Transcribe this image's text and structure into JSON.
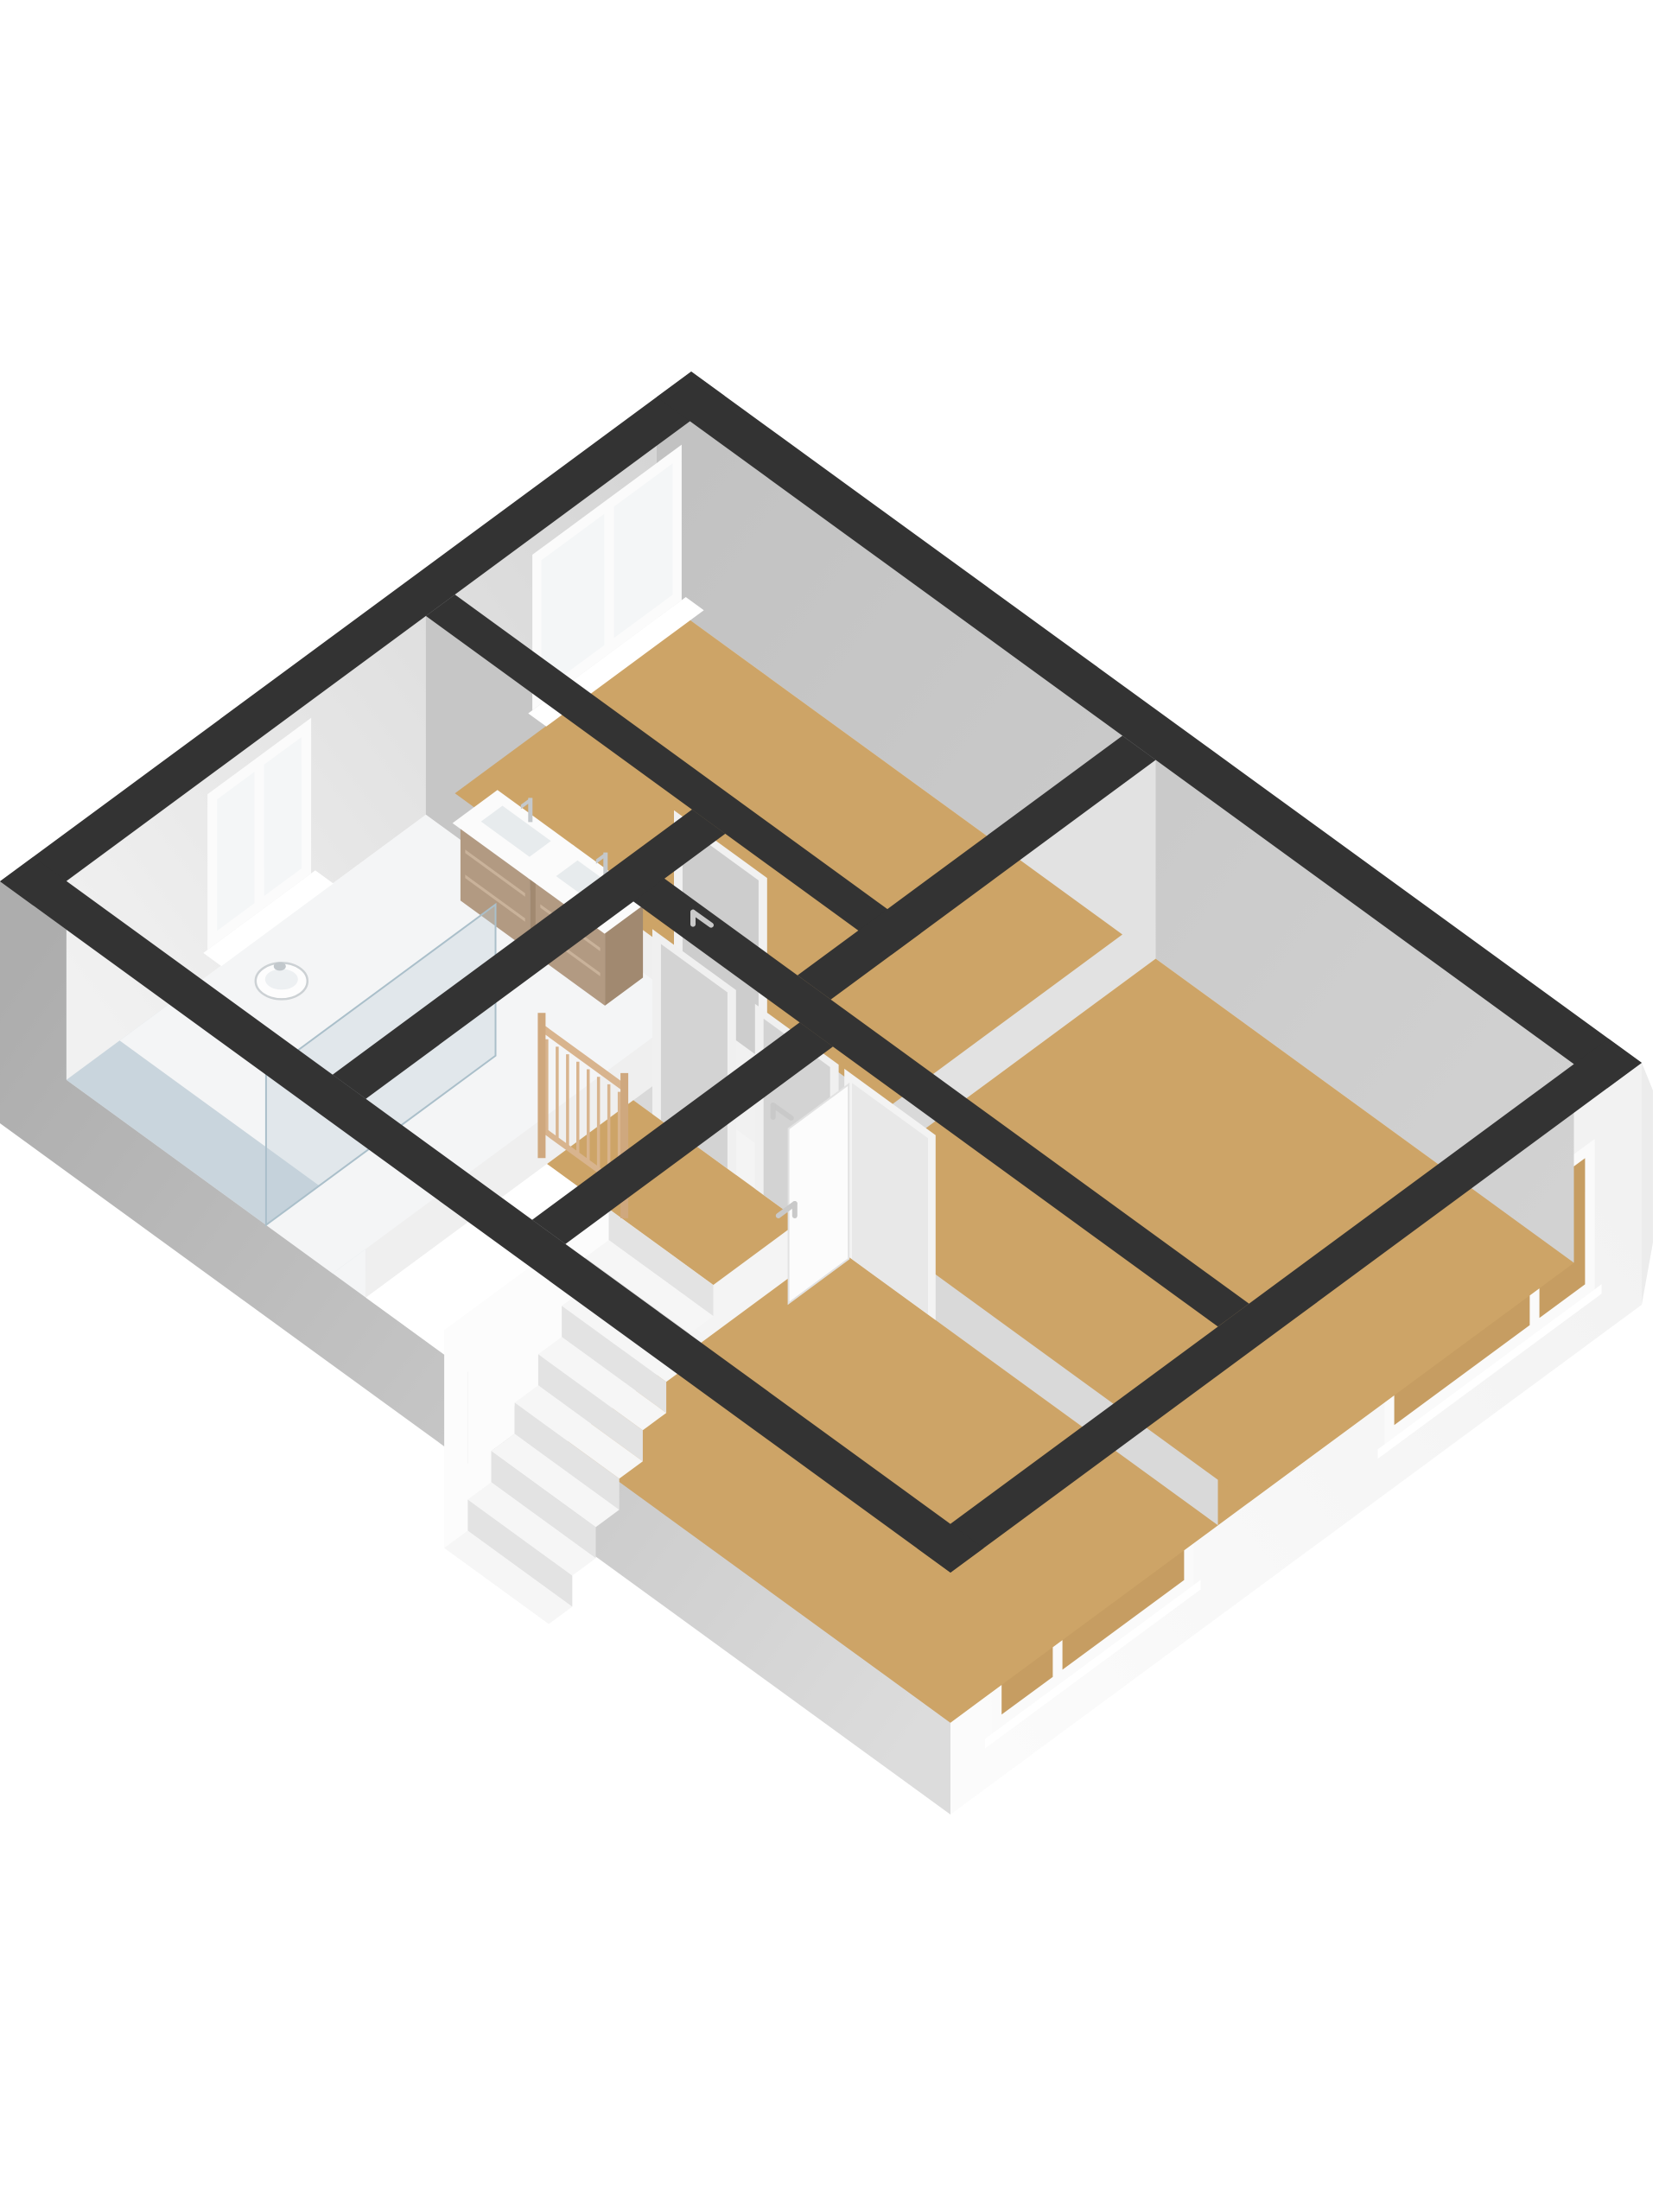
{
  "meta": {
    "description": "3D floor plan render of an upper floor with three bedrooms, bathroom, landing and staircase",
    "background": "#ffffff"
  },
  "palette": {
    "wall_top": "#333333",
    "wood_floor": "#cda467",
    "light_floor": "#f1f1f1",
    "bath_floor": "#f4f5f6",
    "shower_floor": "#c9d5dd",
    "exterior_gray": "#b0b0b0",
    "exterior_white": "#f7f7f7",
    "railing_wood": "#d8b48e",
    "vanity_wood": "#b29a82"
  },
  "scene": {
    "projection": {
      "origin": [
        800,
        430
      ],
      "uAxis": [
        1100,
        800
      ],
      "vAxis": [
        -800,
        590
      ],
      "floorZ": 230,
      "wallZ": 280
    },
    "gradients": [
      {
        "id": "gw1",
        "a": [
          0.035,
          0.05,
          100
        ],
        "b": [
          0.035,
          0.952,
          100
        ],
        "stops": [
          [
            0,
            "#d5d5d5"
          ],
          [
            1,
            "#f1f1f1"
          ]
        ]
      },
      {
        "id": "gw2",
        "a": [
          0,
          0.05,
          100
        ],
        "b": [
          1,
          0.05,
          100
        ],
        "stops": [
          [
            0,
            "#c2c2c2"
          ],
          [
            1,
            "#d2d2d2"
          ]
        ]
      },
      {
        "id": "gw3",
        "a": [
          1,
          0,
          140
        ],
        "b": [
          1,
          1,
          140
        ],
        "stops": [
          [
            0,
            "#f2f2f2"
          ],
          [
            1,
            "#fbfbfb"
          ]
        ]
      },
      {
        "id": "gw4",
        "a": [
          0,
          1,
          140
        ],
        "b": [
          1,
          1,
          140
        ],
        "stops": [
          [
            0,
            "#adadad"
          ],
          [
            1,
            "#dcdcdc"
          ]
        ]
      }
    ],
    "items": [
      {
        "type": "uquad",
        "name": "exterior-face-bottom-right-wall",
        "u": 1,
        "v0": 0,
        "v1": 1,
        "z0": 0,
        "z1": 280,
        "fill": "url(#gw3)"
      },
      {
        "type": "vquad",
        "name": "exterior-face-bottom-left-wall",
        "v": 1,
        "u0": 0,
        "u1": 1,
        "z0": 0,
        "z1": 280,
        "fill": "url(#gw4)"
      },
      {
        "type": "poly",
        "name": "right-corner-edge-sliver",
        "points": [
          [
            1900,
            1230
          ],
          [
            1913,
            1262
          ],
          [
            1913,
            1438
          ],
          [
            1900,
            1510
          ]
        ],
        "fill": "#ececec"
      },
      {
        "type": "uquad",
        "name": "window-right-bedroom-frame",
        "u": 1,
        "v0": 0.068,
        "v1": 0.372,
        "z0": 48,
        "z1": 222,
        "fill": "#fafafa"
      },
      {
        "type": "uquad",
        "name": "window-right-bedroom-pane-small",
        "u": 1,
        "v0": 0.082,
        "v1": 0.148,
        "z0": 62,
        "z1": 208,
        "fill": "#c69d62"
      },
      {
        "type": "uquad",
        "name": "window-right-bedroom-pane-large",
        "u": 1,
        "v0": 0.162,
        "v1": 0.358,
        "z0": 62,
        "z1": 208,
        "fill": "#c69d62"
      },
      {
        "type": "uquad",
        "name": "window-right-bedroom-sill",
        "u": 1,
        "v0": 0.058,
        "v1": 0.382,
        "z0": 222,
        "z1": 233,
        "fill": "#ffffff"
      },
      {
        "type": "uquad",
        "name": "window-bottom-bedroom-frame",
        "u": 1,
        "v0": 0.648,
        "v1": 0.94,
        "z0": 48,
        "z1": 222,
        "fill": "#fafafa"
      },
      {
        "type": "uquad",
        "name": "window-bottom-bedroom-pane-large",
        "u": 1,
        "v0": 0.662,
        "v1": 0.838,
        "z0": 62,
        "z1": 208,
        "fill": "#c69d62"
      },
      {
        "type": "uquad",
        "name": "window-bottom-bedroom-pane-small",
        "u": 1,
        "v0": 0.852,
        "v1": 0.926,
        "z0": 62,
        "z1": 208,
        "fill": "#c69d62"
      },
      {
        "type": "uquad",
        "name": "window-bottom-bedroom-sill",
        "u": 1,
        "v0": 0.638,
        "v1": 0.95,
        "z0": 222,
        "z1": 233,
        "fill": "#ffffff"
      },
      {
        "type": "uquad",
        "name": "floor-skirt-right-wall",
        "u": 0.965,
        "v0": 0.05,
        "v1": 0.952,
        "z0": 0,
        "z1": 230,
        "fill": "#cda467"
      },
      {
        "type": "vquad",
        "name": "floor-skirt-bottom-wall-shower",
        "v": 0.952,
        "u0": 0.035,
        "u1": 0.245,
        "z0": 0,
        "z1": 230,
        "fill": "#c9d5dd"
      },
      {
        "type": "vquad",
        "name": "floor-skirt-bottom-wall-bath",
        "v": 0.952,
        "u0": 0.245,
        "u1": 0.35,
        "z0": 0,
        "z1": 230,
        "fill": "#f4f5f6"
      },
      {
        "type": "vquad",
        "name": "floor-skirt-bottom-wall-stairwell",
        "v": 0.952,
        "u0": 0.35,
        "u1": 0.56,
        "z0": 0,
        "z1": 230,
        "fill": "#fdfdfd"
      },
      {
        "type": "vquad",
        "name": "floor-skirt-bottom-wall-bedroom",
        "v": 0.952,
        "u0": 0.56,
        "u1": 0.965,
        "z0": 0,
        "z1": 230,
        "fill": "#cda467"
      },
      {
        "type": "vquad",
        "name": "floor-skirt-top-bedroom-south",
        "v": 0.39,
        "u0": 0.035,
        "u1": 0.525,
        "z0": 0,
        "z1": 230,
        "fill": "#cda467"
      },
      {
        "type": "uquad",
        "name": "floor-skirt-top-bedroom-east",
        "u": 0.49,
        "v0": 0.05,
        "v1": 0.39,
        "z0": 0,
        "z1": 230,
        "fill": "#cda467"
      },
      {
        "type": "uquad",
        "name": "floor-skirt-hall-east",
        "u": 0.49,
        "v0": 0.39,
        "v1": 0.52,
        "z0": 0,
        "z1": 230,
        "fill": "#f1f1f1"
      },
      {
        "type": "vquad",
        "name": "floor-skirt-hall-south",
        "v": 0.52,
        "u0": 0.345,
        "u1": 0.525,
        "z0": 0,
        "z1": 230,
        "fill": "#f1f1f1"
      },
      {
        "type": "vquad",
        "name": "floor-skirt-right-bedroom-south",
        "v": 0.52,
        "u0": 0.525,
        "u1": 0.965,
        "z0": 0,
        "z1": 230,
        "fill": "#cda467"
      },
      {
        "type": "uquad",
        "name": "floor-skirt-bathroom-east",
        "u": 0.315,
        "v0": 0.432,
        "v1": 0.875,
        "z0": 0,
        "z1": 230,
        "fill": "#f4f5f6"
      },
      {
        "type": "uquad",
        "name": "floor-skirt-shower-east",
        "u": 0.315,
        "v0": 0.875,
        "v1": 0.952,
        "z0": 0,
        "z1": 230,
        "fill": "#c9d5dd"
      },
      {
        "type": "uquad",
        "name": "floor-skirt-landing-east",
        "u": 0.525,
        "v0": 0.565,
        "v1": 0.69,
        "z0": 0,
        "z1": 230,
        "fill": "#cda467"
      },
      {
        "type": "uquad",
        "name": "floor-skirt-stairs-east",
        "u": 0.525,
        "v0": 0.69,
        "v1": 0.952,
        "z0": 0,
        "z1": 230,
        "fill": "#fdfdfd"
      },
      {
        "type": "uquad",
        "name": "interior-face-top-left-wall",
        "u": 0.035,
        "v0": 0.05,
        "v1": 0.952,
        "z0": 0,
        "z1": 230,
        "fill": "url(#gw1)"
      },
      {
        "type": "vquad",
        "name": "interior-face-top-right-wall",
        "v": 0.05,
        "u0": 0,
        "u1": 0.965,
        "z0": 0,
        "z1": 230,
        "fill": "url(#gw2)"
      },
      {
        "type": "vquad",
        "name": "interior-face-partition-top-bedroom",
        "v": 0.432,
        "u0": 0.035,
        "u1": 0.525,
        "z0": 0,
        "z1": 230,
        "fill": "#c6c6c6"
      },
      {
        "type": "uquad",
        "name": "interior-face-partition-right-bedroom-west",
        "u": 0.525,
        "v0": 0.05,
        "v1": 0.52,
        "z0": 0,
        "z1": 230,
        "fill": "#e2e2e2"
      },
      {
        "type": "vquad",
        "name": "interior-face-partition-landing-north",
        "v": 0.565,
        "u0": 0.345,
        "u1": 0.965,
        "z0": 0,
        "z1": 230,
        "fill": "#d9d9d9"
      },
      {
        "type": "uquad",
        "name": "interior-face-partition-bathroom-east",
        "u": 0.35,
        "v0": 0.432,
        "v1": 0.952,
        "z0": 0,
        "z1": 230,
        "fill": "#efefef"
      },
      {
        "type": "uquad",
        "name": "interior-face-partition-bottom-bedroom-west",
        "u": 0.56,
        "v0": 0.565,
        "v1": 0.952,
        "z0": 0,
        "z1": 230,
        "fill": "#f4f4f4"
      },
      {
        "type": "plan",
        "name": "floor-top-bedroom",
        "u0": 0.035,
        "u1": 0.49,
        "v0": 0.05,
        "v1": 0.39,
        "z": 230,
        "fill": "#cda467"
      },
      {
        "type": "plan",
        "name": "floor-right-bedroom",
        "u0": 0.525,
        "u1": 0.965,
        "v0": 0.05,
        "v1": 0.52,
        "z": 230,
        "fill": "#cda467"
      },
      {
        "type": "plan",
        "name": "floor-bottom-bedroom",
        "u0": 0.56,
        "u1": 0.965,
        "v0": 0.565,
        "v1": 0.952,
        "z": 230,
        "fill": "#cda467"
      },
      {
        "type": "plan",
        "name": "floor-hallway",
        "u0": 0.35,
        "u1": 0.49,
        "v0": 0.432,
        "v1": 0.52,
        "z": 230,
        "fill": "#f1f1f1"
      },
      {
        "type": "plan",
        "name": "floor-landing",
        "u0": 0.35,
        "u1": 0.525,
        "v0": 0.565,
        "v1": 0.69,
        "z": 230,
        "fill": "#cda467"
      },
      {
        "type": "plan",
        "name": "floor-bathroom",
        "u0": 0.035,
        "u1": 0.315,
        "v0": 0.432,
        "v1": 0.952,
        "z": 230,
        "fill": "#f4f5f6"
      },
      {
        "type": "plan",
        "name": "floor-shower",
        "u0": 0.035,
        "u1": 0.245,
        "v0": 0.875,
        "v1": 0.952,
        "z": 230,
        "fill": "#c9d5dd"
      },
      {
        "type": "plan",
        "name": "floor-stair-void",
        "u0": 0.35,
        "u1": 0.525,
        "v0": 0.69,
        "v1": 0.952,
        "z": 230,
        "fill": "#ffffff"
      },
      {
        "type": "uquad",
        "name": "window-top-bedroom-frame",
        "u": 0.035,
        "v0": 0.062,
        "v1": 0.278,
        "z0": 20,
        "z1": 200,
        "fill": "#fbfbfb"
      },
      {
        "type": "uquad",
        "name": "window-top-bedroom-pane-left",
        "u": 0.035,
        "v0": 0.174,
        "v1": 0.265,
        "z0": 34,
        "z1": 186,
        "fill": "#f4f6f7"
      },
      {
        "type": "uquad",
        "name": "window-top-bedroom-pane-right",
        "u": 0.035,
        "v0": 0.075,
        "v1": 0.16,
        "z0": 34,
        "z1": 186,
        "fill": "#f4f6f7"
      },
      {
        "type": "plan",
        "name": "window-top-bedroom-sill",
        "u0": 0.035,
        "u1": 0.054,
        "v0": 0.056,
        "v1": 0.284,
        "z": 200,
        "fill": "#ffffff"
      },
      {
        "type": "uquad",
        "name": "window-bathroom-frame",
        "u": 0.035,
        "v0": 0.598,
        "v1": 0.748,
        "z0": 20,
        "z1": 200,
        "fill": "#fbfbfb"
      },
      {
        "type": "uquad",
        "name": "window-bathroom-pane-left",
        "u": 0.035,
        "v0": 0.68,
        "v1": 0.734,
        "z0": 34,
        "z1": 186,
        "fill": "#f4f6f7"
      },
      {
        "type": "uquad",
        "name": "window-bathroom-pane-right",
        "u": 0.035,
        "v0": 0.612,
        "v1": 0.666,
        "z0": 34,
        "z1": 186,
        "fill": "#f4f6f7"
      },
      {
        "type": "plan",
        "name": "window-bathroom-sill",
        "u0": 0.035,
        "u1": 0.054,
        "v0": 0.592,
        "v1": 0.754,
        "z": 200,
        "fill": "#ffffff"
      },
      {
        "type": "vquad",
        "name": "door-top-bedroom-frame",
        "v": 0.432,
        "u0": 0.296,
        "u1": 0.394,
        "z0": 16,
        "z1": 230,
        "fill": "#f1f1f1"
      },
      {
        "type": "vquad",
        "name": "door-top-bedroom-leaf",
        "v": 0.432,
        "u0": 0.305,
        "u1": 0.385,
        "z0": 26,
        "z1": 230,
        "fill": "#cdcdcd"
      },
      {
        "type": "vquad",
        "name": "door-landing-left-frame",
        "v": 0.565,
        "u0": 0.37,
        "u1": 0.458,
        "z0": 16,
        "z1": 230,
        "fill": "#f0f0f0"
      },
      {
        "type": "vquad",
        "name": "door-landing-left-leaf",
        "v": 0.565,
        "u0": 0.379,
        "u1": 0.449,
        "z0": 26,
        "z1": 230,
        "fill": "#d3d3d3"
      },
      {
        "type": "vquad",
        "name": "door-landing-right-frame",
        "v": 0.565,
        "u0": 0.478,
        "u1": 0.566,
        "z0": 16,
        "z1": 230,
        "fill": "#f0f0f0"
      },
      {
        "type": "vquad",
        "name": "door-landing-right-leaf",
        "v": 0.565,
        "u0": 0.487,
        "u1": 0.557,
        "z0": 26,
        "z1": 230,
        "fill": "#d3d3d3"
      },
      {
        "type": "vquad",
        "name": "door-bottom-bedroom-frame",
        "v": 0.565,
        "u0": 0.572,
        "u1": 0.668,
        "z0": 16,
        "z1": 230,
        "fill": "#f3f3f3"
      },
      {
        "type": "vquad",
        "name": "door-bottom-bedroom-opening",
        "v": 0.565,
        "u0": 0.58,
        "u1": 0.66,
        "z0": 26,
        "z1": 230,
        "fill": "#e8e8e8"
      },
      {
        "type": "stairs",
        "name": "staircase",
        "u0": 0.415,
        "u1": 0.525,
        "vStart": 0.69,
        "depth": 0.034,
        "count": 7,
        "drop": 36,
        "treadFill": "#f6f6f6",
        "riserFill": "#e3e3e3",
        "stringerFill": "#fcfcfc"
      },
      {
        "type": "vanity",
        "name": "bathroom-vanity-left",
        "u0": 0.115,
        "u1": 0.188,
        "v0": 0.437,
        "v1": 0.492,
        "topZ": 140,
        "wood": "#b29a82",
        "side": "#a18970",
        "top": "#fbfbfb",
        "basin": "#e7ebed",
        "groove": "#c9b29a",
        "faucet": "#c4c8cb"
      },
      {
        "type": "vanity",
        "name": "bathroom-vanity-right",
        "u0": 0.194,
        "u1": 0.267,
        "v0": 0.437,
        "v1": 0.492,
        "topZ": 140,
        "wood": "#b29a82",
        "side": "#a18970",
        "top": "#fbfbfb",
        "basin": "#e7ebed",
        "groove": "#c9b29a",
        "faucet": "#c4c8cb"
      },
      {
        "type": "toilet",
        "name": "bathroom-toilet",
        "u": 0.078,
        "v": 0.7
      },
      {
        "type": "uquad",
        "name": "shower-glass-screen",
        "u": 0.245,
        "v0": 0.62,
        "v1": 0.952,
        "z0": 55,
        "z1": 230,
        "fill": "rgba(188,205,216,0.35)",
        "stroke": "#aabfca",
        "sw": 2
      },
      {
        "type": "uquad",
        "name": "door-bottom-bedroom-open-leaf",
        "u": 0.578,
        "v0": 0.567,
        "v1": 0.654,
        "z0": 28,
        "z1": 230,
        "fill": "#fcfcfc",
        "stroke": "#e2e2e2",
        "sw": 2
      },
      {
        "type": "railing",
        "name": "stair-railing",
        "v": 0.688,
        "u0": 0.343,
        "u1": 0.43,
        "balusters": 8,
        "wood": "#d8b48e",
        "post": "#cfa87e"
      },
      {
        "type": "plan",
        "name": "wall-top-top-left",
        "u0": 0,
        "u1": 0.035,
        "v0": 0,
        "v1": 1,
        "z": 0,
        "fill": "#333333"
      },
      {
        "type": "plan",
        "name": "wall-top-top-right",
        "u0": 0,
        "u1": 1,
        "v0": 0,
        "v1": 0.05,
        "z": 0,
        "fill": "#333333"
      },
      {
        "type": "plan",
        "name": "wall-top-bottom-right",
        "u0": 0.965,
        "u1": 1,
        "v0": 0,
        "v1": 1,
        "z": 0,
        "fill": "#333333"
      },
      {
        "type": "plan",
        "name": "wall-top-bottom-left",
        "u0": 0,
        "u1": 1,
        "v0": 0.952,
        "v1": 1,
        "z": 0,
        "fill": "#333333"
      },
      {
        "type": "plan",
        "name": "wall-top-partition-top-bedroom",
        "u0": 0.035,
        "u1": 0.525,
        "v0": 0.39,
        "v1": 0.432,
        "z": 0,
        "fill": "#333333"
      },
      {
        "type": "plan",
        "name": "wall-top-partition-right-bedroom",
        "u0": 0.49,
        "u1": 0.525,
        "v0": 0.05,
        "v1": 0.52,
        "z": 0,
        "fill": "#333333"
      },
      {
        "type": "plan",
        "name": "wall-top-partition-landing",
        "u0": 0.345,
        "u1": 0.965,
        "v0": 0.52,
        "v1": 0.565,
        "z": 0,
        "fill": "#333333"
      },
      {
        "type": "plan",
        "name": "wall-top-partition-bathroom",
        "u0": 0.315,
        "u1": 0.35,
        "v0": 0.432,
        "v1": 0.952,
        "z": 0,
        "fill": "#333333"
      },
      {
        "type": "plan",
        "name": "wall-top-partition-bottom-bedroom",
        "u0": 0.525,
        "u1": 0.56,
        "v0": 0.565,
        "v1": 0.952,
        "z": 0,
        "fill": "#333333"
      },
      {
        "type": "handle",
        "name": "door-handle-top-bedroom",
        "u": 0.316,
        "v": 0.432,
        "z": 118,
        "dir": "A"
      },
      {
        "type": "handle",
        "name": "door-handle-landing-right",
        "u": 0.497,
        "v": 0.565,
        "z": 118,
        "dir": "A"
      },
      {
        "type": "handle",
        "name": "door-handle-bottom-bedroom-leaf",
        "u": 0.578,
        "v": 0.645,
        "z": 120,
        "dir": "B"
      }
    ]
  }
}
